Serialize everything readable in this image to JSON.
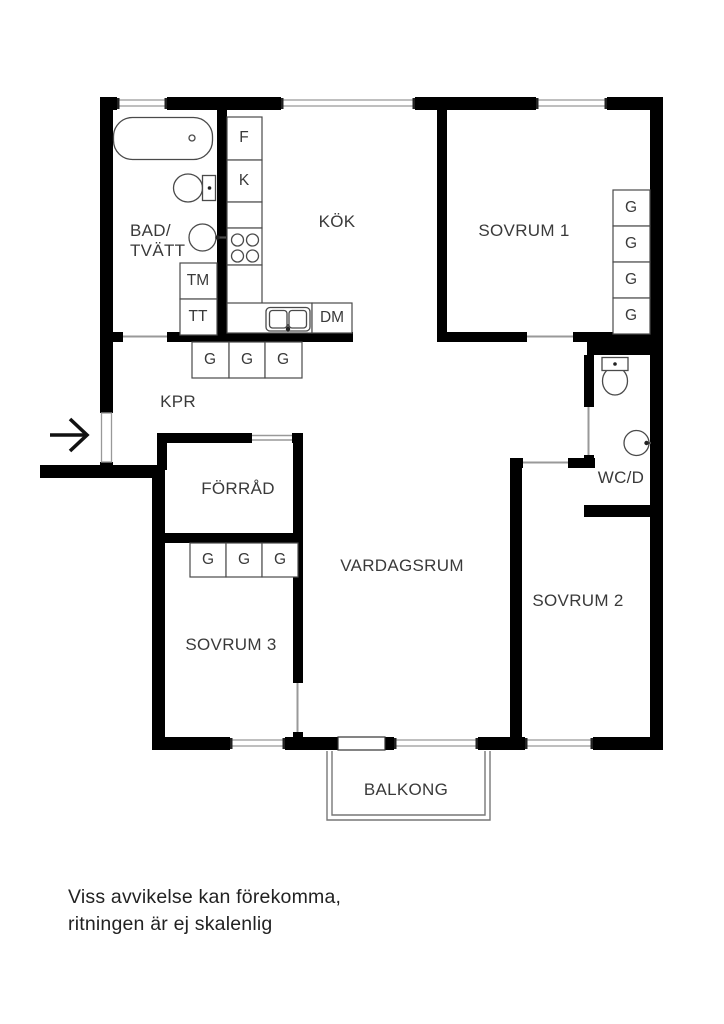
{
  "rooms": {
    "bad_tvatt_line1": "BAD/",
    "bad_tvatt_line2": "TVÄTT",
    "kok": "KÖK",
    "sovrum1": "SOVRUM 1",
    "kpr": "KPR",
    "forrad": "FÖRRÅD",
    "vardagsrum": "VARDAGSRUM",
    "sovrum2": "SOVRUM 2",
    "sovrum3": "SOVRUM 3",
    "wcd": "WC/D",
    "balkong": "BALKONG"
  },
  "appliances": {
    "f": "F",
    "k": "K",
    "tm": "TM",
    "tt": "TT",
    "dm": "DM"
  },
  "closets": {
    "kpr_row": [
      "G",
      "G",
      "G"
    ],
    "sovrum1_col": [
      "G",
      "G",
      "G",
      "G"
    ],
    "sovrum3_row": [
      "G",
      "G",
      "G"
    ]
  },
  "footer": {
    "line1": "Viss avvikelse kan förekomma,",
    "line2": "ritningen är ej skalenlig"
  },
  "colors": {
    "wall": "#000000",
    "fixture_stroke": "#4a4a4a",
    "window_line": "#aaaaaa",
    "door_line": "#999999",
    "text": "#3a3a3a"
  }
}
